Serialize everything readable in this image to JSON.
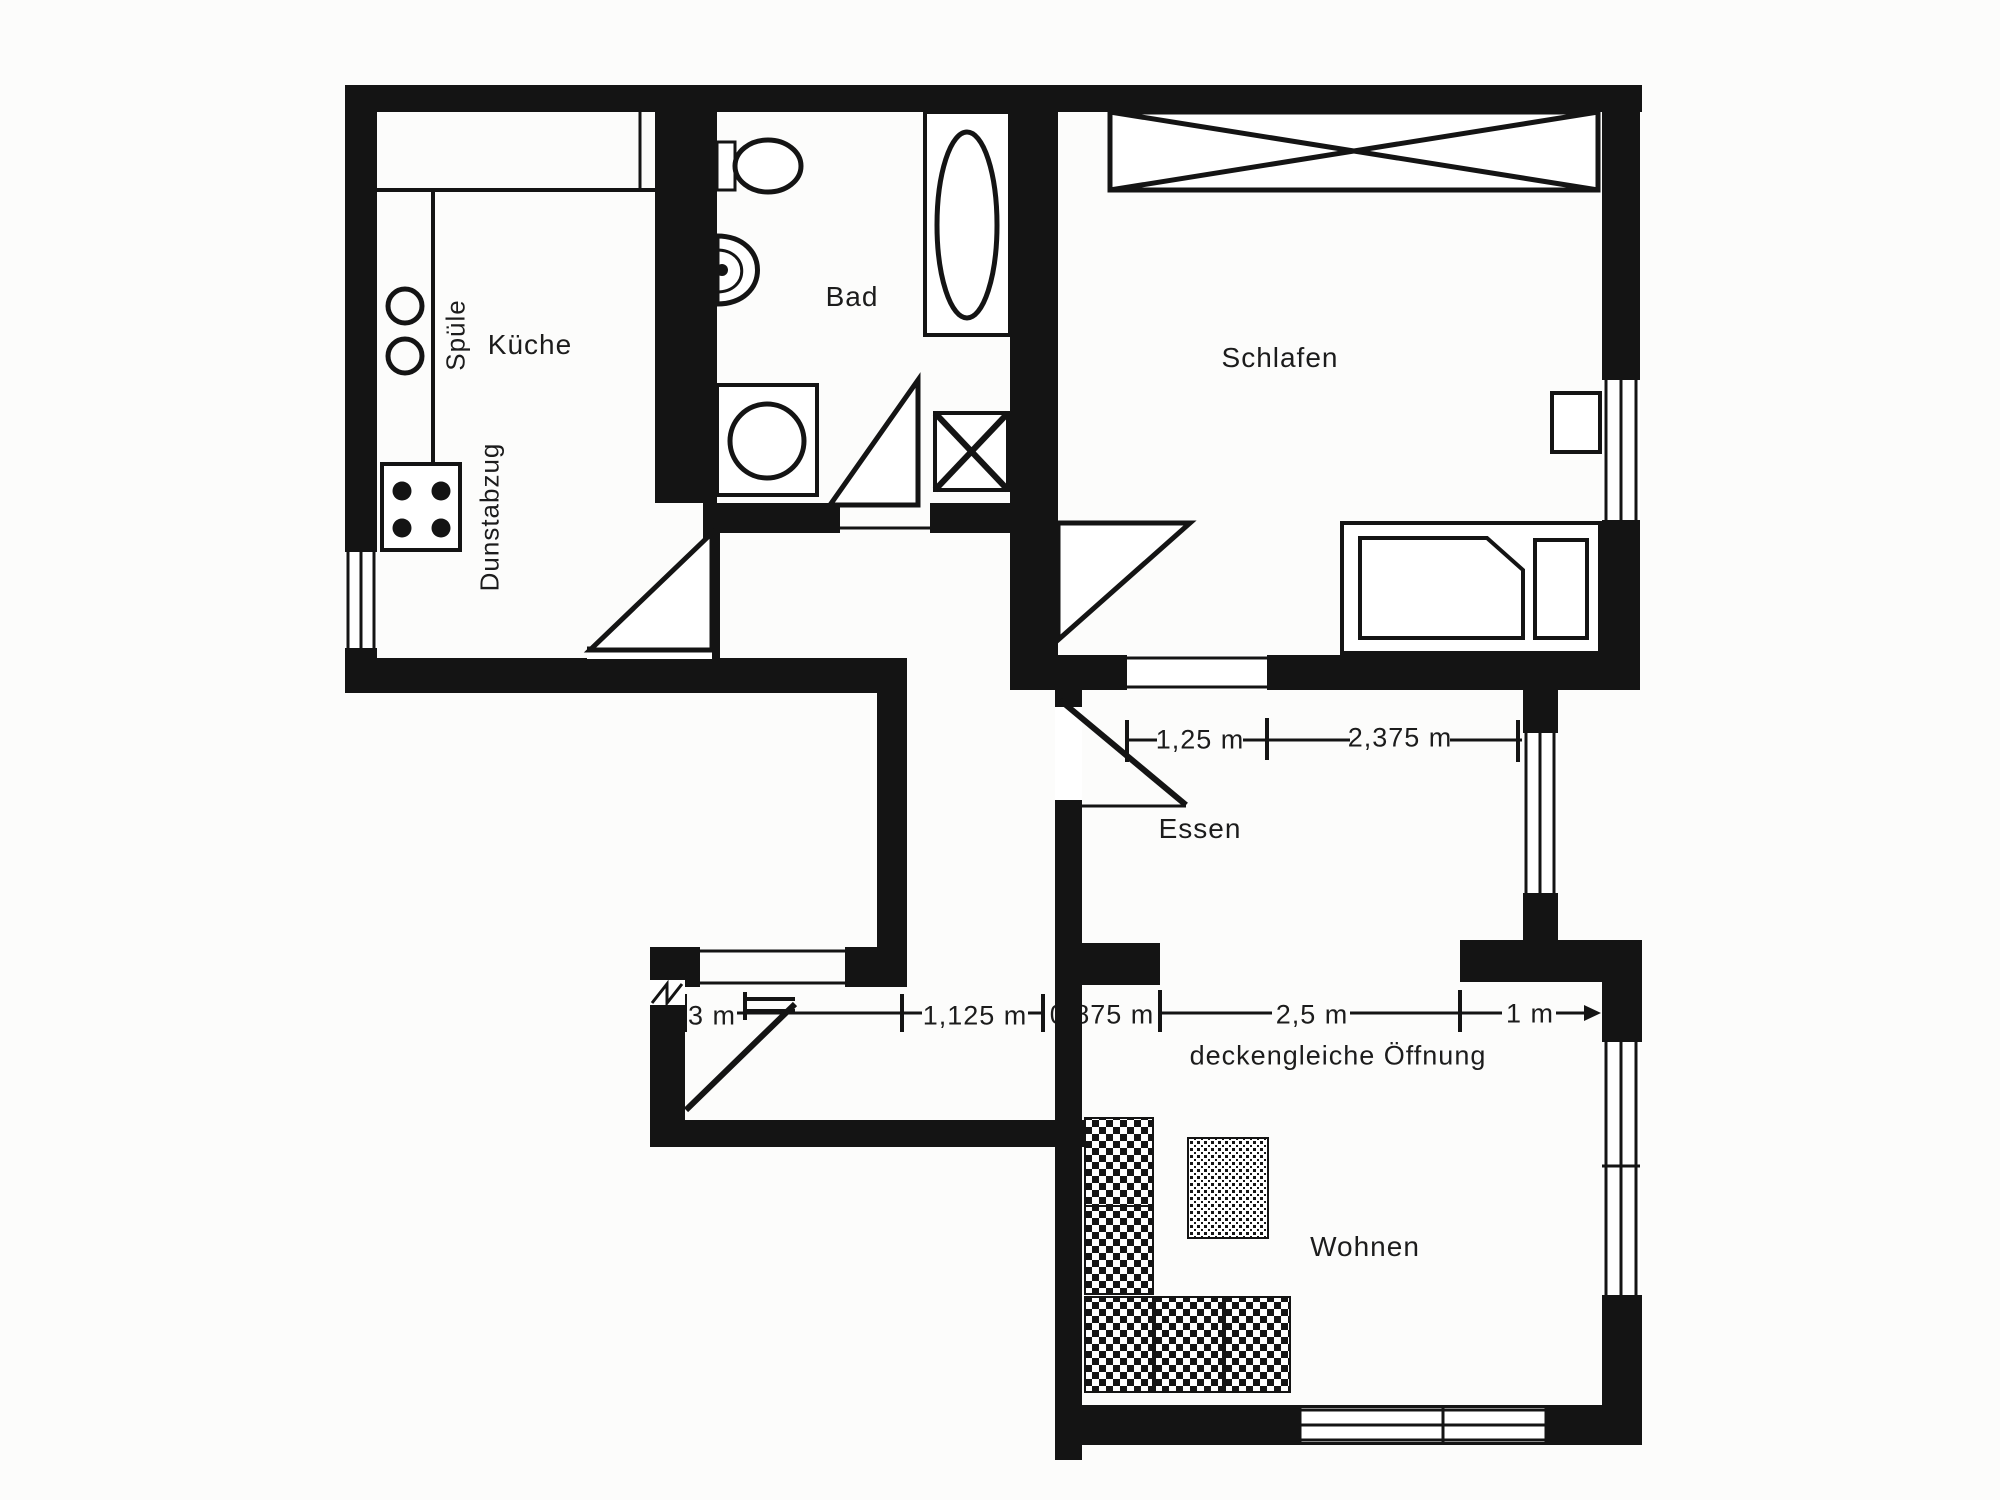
{
  "floorplan": {
    "paper_color": "#fcfcfb",
    "ink_color": "#141414",
    "rooms": [
      {
        "id": "kitchen",
        "label": "Küche"
      },
      {
        "id": "bath",
        "label": "Bad"
      },
      {
        "id": "bedroom",
        "label": "Schlafen"
      },
      {
        "id": "dining",
        "label": "Essen"
      },
      {
        "id": "living",
        "label": "Wohnen"
      }
    ],
    "kitchen_annotations": [
      {
        "id": "sink",
        "label": "Spüle"
      },
      {
        "id": "extractor-hood",
        "label": "Dunstabzug"
      }
    ],
    "dimensions_upper": [
      {
        "label": "1,25 m"
      },
      {
        "label": "2,375 m"
      }
    ],
    "dimensions_lower": [
      {
        "label": "3 m"
      },
      {
        "label": "1,125 m"
      },
      {
        "label": "0,875 m"
      },
      {
        "label": "2,5 m"
      },
      {
        "label": "1 m"
      }
    ],
    "annotation_opening": {
      "label": "deckengleiche Öffnung"
    },
    "fixtures": [
      "sink-icon",
      "stove-icon",
      "counter-icon",
      "toilet-icon",
      "washbasin-icon",
      "bathtub-icon",
      "washing-machine-icon",
      "duct-shaft-icon",
      "wardrobe-icon",
      "bed-icon",
      "nightstand-icon",
      "sofa-icon",
      "table-icon",
      "door-swing-icon",
      "window-icon",
      "entrance-door-icon"
    ]
  }
}
